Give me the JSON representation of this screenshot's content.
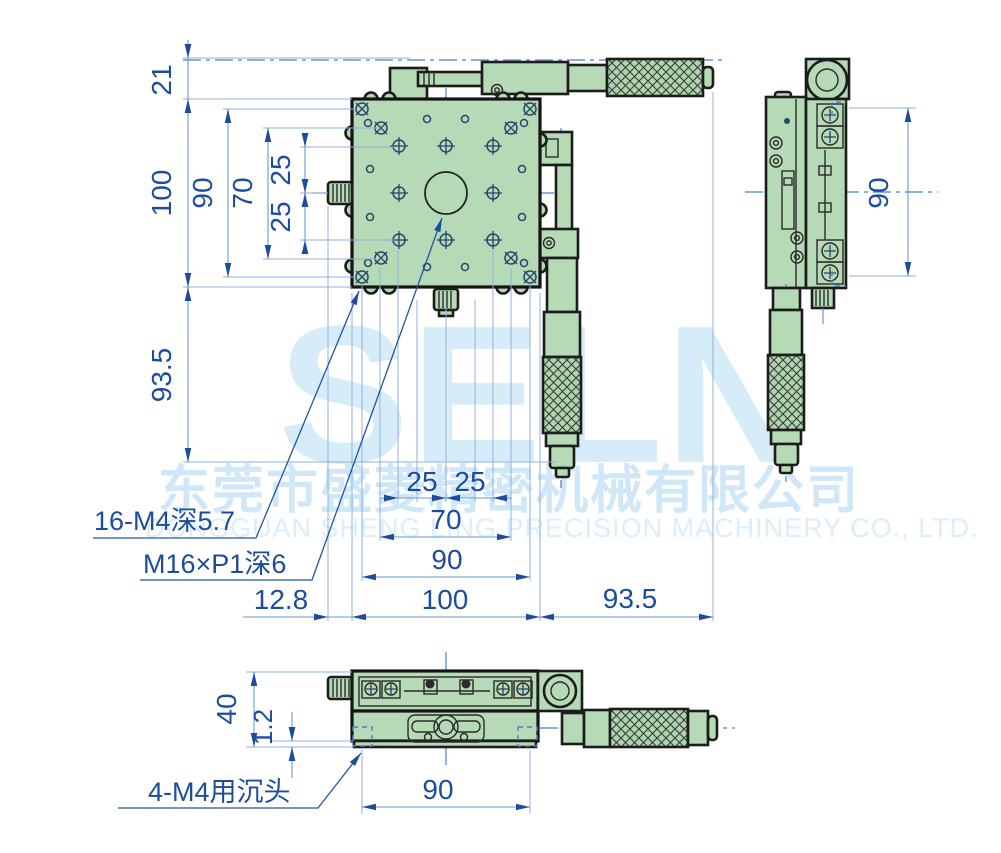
{
  "watermark": {
    "logo": "SELN",
    "company_cn": "东莞市盛菱精密机械有限公司",
    "company_en": "DONGGUAN SHENG LING PRECISION MACHINERY CO., LTD."
  },
  "labels": {
    "top_thread": "16-M4深5.7",
    "center_thread": "M16×P1深6",
    "base_counterbore": "4-M4用沉头"
  },
  "dims": {
    "left": {
      "offset": "21",
      "height": "100",
      "rows": "90",
      "inner": "70",
      "q1": "25",
      "q2": "25",
      "depth": "93.5"
    },
    "mid": {
      "q1": "25",
      "q2": "25",
      "inner": "70",
      "outer": "90",
      "knob": "12.8",
      "width": "100",
      "mic": "93.5"
    },
    "side": {
      "height": "90"
    },
    "base": {
      "height": "40",
      "lip": "1.2",
      "span": "90"
    }
  }
}
